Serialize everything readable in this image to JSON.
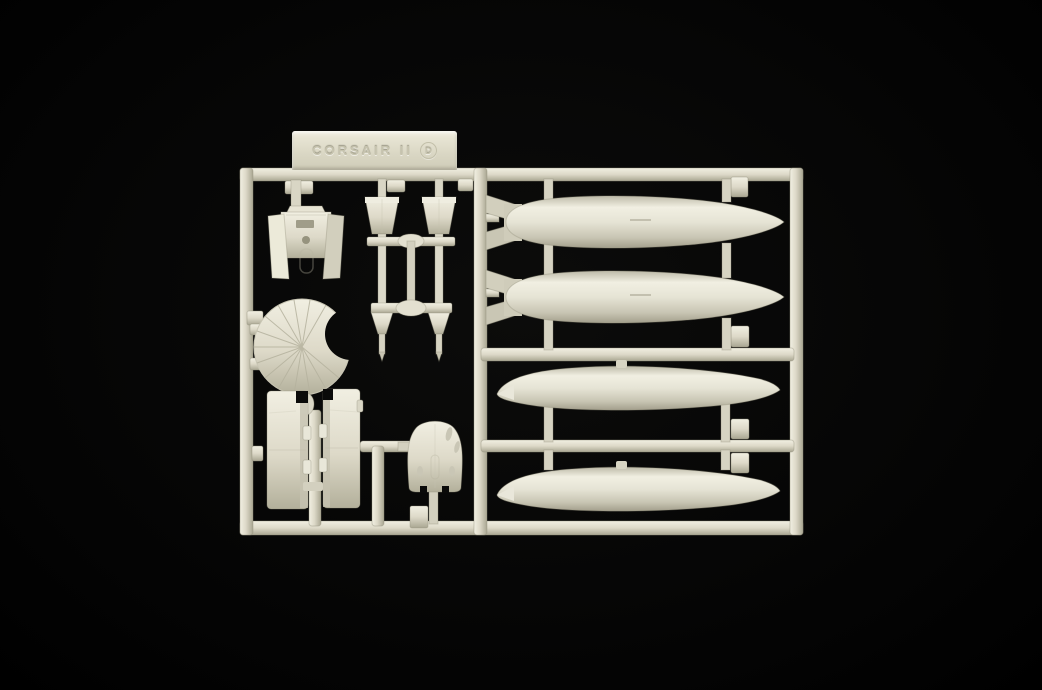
{
  "photo": {
    "subject": "Injection-molded plastic model kit sprue (parts tree) photographed on a black background",
    "background_color": "#050505",
    "plastic": {
      "base": "#ddd9c8",
      "highlight": "#f1efe2",
      "mid": "#d9d6c5",
      "shadow": "#a9a692",
      "edge": "#8f8c77"
    }
  },
  "label": {
    "text": "CORSAIR II",
    "sprue_letter": "D"
  },
  "parts": {
    "left_bay": [
      "cockpit-bulkhead",
      "finned-bomb x2",
      "cowl-flap-fan-segment",
      "landing-gear-door x2",
      "cowling-dome"
    ],
    "right_bay": [
      "finned-drop-tank x2",
      "smooth-drop-tank x2"
    ]
  }
}
